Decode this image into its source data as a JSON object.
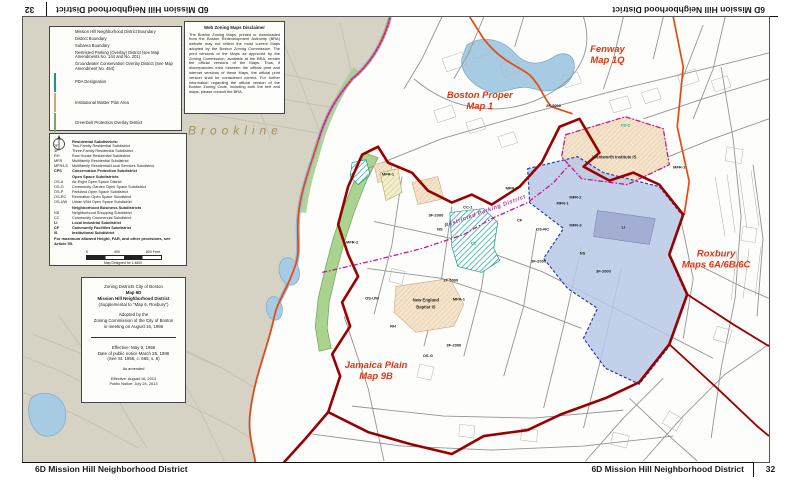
{
  "bars": {
    "title": "6D Mission Hill Neighborhood District",
    "page_number": "32"
  },
  "disclaimer": {
    "title": "Web Zoning Maps Disclaimer",
    "body": "The Boston Zoning Maps, printed or downloaded from the Boston Redevelopment Authority (BRA) website may not reflect the most current Maps adopted by the Boston Zoning Commission. The print versions of the Maps as approved by the Zoning Commission, available at the BRA, remain the official versions of the Maps. Thus, if discrepancies exist between the official print and internet versions of these Maps, the official print version shall be considered correct. For further information regarding the official version of the Boston Zoning Code, including both the text and maps, please consult the BRA."
  },
  "legend_overlays": {
    "items": [
      {
        "sw": "line-dark",
        "label": "Mission Hill Neighborhood District Boundary"
      },
      {
        "sw": "line-orange",
        "label": "District Boundary"
      },
      {
        "sw": "line-gray",
        "label": "Subarea Boundary"
      },
      {
        "sw": "dash-pink",
        "label": "Restricted Parking (Overlay) District (see Map Amendments No. 144 and No. 201)"
      },
      {
        "sw": "dots-pink",
        "label": "Groundwater Conservation Overlay District (See Map Amendment No. 454)"
      },
      {
        "sw": "teal",
        "label": "PDA Designation"
      },
      {
        "sw": "peach",
        "label": "Institutional Master Plan Area"
      },
      {
        "sw": "green",
        "label": "Greenbelt Protection Overlay District"
      },
      {
        "sw": "blue",
        "label": "Special Study Overlay District"
      },
      {
        "sw": "text",
        "code": "CC, CPS",
        "label": "PDA Permitted"
      }
    ]
  },
  "legend_subdistricts": {
    "sections": [
      {
        "header": "Residential Subdistricts:",
        "rows": [
          [
            "2F",
            "Two-Family Residential Subdistrict"
          ],
          [
            "3F",
            "Three-Family Residential Subdistrict"
          ],
          [
            "RH",
            "Row House Residential Subdistrict"
          ],
          [
            "MFR",
            "Multifamily Residential Subdistrict"
          ],
          [
            "MFR/LS",
            "Multifamily Residential/Local Services Subdistrict"
          ]
        ]
      },
      {
        "header": "",
        "bold": true,
        "rows": [
          [
            "CPS",
            "Conservation Protection Subdistrict"
          ]
        ]
      },
      {
        "header": "Open Space Subdistricts",
        "rows": [
          [
            "OS-A",
            "Air-Right Open Space District"
          ],
          [
            "OS-G",
            "Community Garden Open Space Subdistrict"
          ],
          [
            "OS-P",
            "Parkland Open Space Subdistrict"
          ],
          [
            "OS-RC",
            "Recreation Open Space Subdistrict"
          ],
          [
            "OS-UW",
            "Urban Wild Open Space Subdistrict"
          ]
        ]
      },
      {
        "header": "Neighborhood Business Subdistricts",
        "rows": [
          [
            "NS",
            "Neighborhood Shopping Subdistrict"
          ],
          [
            "CC",
            "Community Commercial Subdistrict"
          ]
        ]
      },
      {
        "header": "",
        "bold": true,
        "rows": [
          [
            "LI",
            "Local Industrial Subdistrict"
          ]
        ]
      },
      {
        "header": "",
        "bold": true,
        "rows": [
          [
            "CF",
            "Community Facilities Subdistrict"
          ]
        ]
      },
      {
        "header": "",
        "bold": true,
        "rows": [
          [
            "IS",
            "Institutional Subdistrict"
          ]
        ]
      }
    ],
    "note": "For maximum allowed Height, FAR, and other provisions, see Article 59."
  },
  "scale": {
    "ticks": [
      "0",
      "400",
      "800 Feet"
    ],
    "caption": "Map Designed for 1:4800"
  },
  "title_block": {
    "lines": [
      {
        "t": "Zoning Districts City of Boston"
      },
      {
        "t": "Map 6D",
        "b": 1
      },
      {
        "t": "Mission Hill Neighborhood District",
        "b": 1
      },
      {
        "t": "(Supplemental to \"Map 6, Roxbury\")"
      },
      {
        "sp": 1
      },
      {
        "t": "Adopted by the"
      },
      {
        "t": "Zoning Commission of the City of Boston"
      },
      {
        "t": "in meeting on August 15, 1996"
      },
      {
        "hr": 1
      },
      {
        "t": "Effective: May 9, 1996"
      },
      {
        "t": "Date of public notice March 25, 1996"
      },
      {
        "t": "(See St. 1956, c. 665, s. 5)"
      },
      {
        "sp": 1
      },
      {
        "t": "As amended",
        "small": 1
      },
      {
        "sp": 1
      },
      {
        "t": "Effective: August 16, 2013",
        "small": 1
      },
      {
        "t": "Public Notice: July 24, 2013",
        "small": 1
      }
    ]
  },
  "map": {
    "labels": [
      {
        "t": "Brookline",
        "x": 213,
        "y": 118,
        "c": "brookline",
        "n": "brookline-label"
      },
      {
        "t": "Boston Proper",
        "x": 458,
        "y": 81,
        "c": "district",
        "n": "boston-proper-label"
      },
      {
        "t": "Map 1",
        "x": 458,
        "y": 92,
        "c": "district",
        "n": "boston-proper-label"
      },
      {
        "t": "Fenway",
        "x": 586,
        "y": 35,
        "c": "district",
        "n": "fenway-label"
      },
      {
        "t": "Map 1Q",
        "x": 586,
        "y": 46,
        "c": "district",
        "n": "fenway-label"
      },
      {
        "t": "Roxbury",
        "x": 695,
        "y": 240,
        "c": "district",
        "n": "roxbury-label"
      },
      {
        "t": "Maps 6A/6B/6C",
        "x": 695,
        "y": 251,
        "c": "district",
        "n": "roxbury-label"
      },
      {
        "t": "Jamaica Plain",
        "x": 354,
        "y": 352,
        "c": "district",
        "n": "jamaica-plain-label"
      },
      {
        "t": "Map 9B",
        "x": 354,
        "y": 363,
        "c": "district",
        "n": "jamaica-plain-label"
      },
      {
        "t": "Restricted Parking District",
        "x": 464,
        "y": 196,
        "c": "parking",
        "r": -20,
        "n": "restricted-parking-label"
      },
      {
        "t": "Wentworth Institute IS",
        "x": 593,
        "y": 142,
        "c": "inst",
        "n": "institution-label"
      },
      {
        "t": "New England",
        "x": 404,
        "y": 285,
        "c": "inst",
        "n": "institution-label"
      },
      {
        "t": "Baptist IS",
        "x": 404,
        "y": 292,
        "c": "inst",
        "n": "institution-label"
      },
      {
        "t": "MFR-1",
        "x": 366,
        "y": 159,
        "c": "zone"
      },
      {
        "t": "MFR-2",
        "x": 330,
        "y": 227,
        "c": "zone"
      },
      {
        "t": "3F-2000",
        "x": 414,
        "y": 200,
        "c": "zone"
      },
      {
        "t": "NS",
        "x": 418,
        "y": 214,
        "c": "zone"
      },
      {
        "t": "CC-1",
        "x": 446,
        "y": 192,
        "c": "zone"
      },
      {
        "t": "CC",
        "x": 452,
        "y": 228,
        "c": "zone-teal"
      },
      {
        "t": "CC-2",
        "x": 604,
        "y": 110,
        "c": "zone-teal"
      },
      {
        "t": "MFR-1",
        "x": 490,
        "y": 173,
        "c": "zone"
      },
      {
        "t": "MFR-2",
        "x": 554,
        "y": 182,
        "c": "zone"
      },
      {
        "t": "MFR-3",
        "x": 554,
        "y": 210,
        "c": "zone"
      },
      {
        "t": "OS-RC",
        "x": 521,
        "y": 214,
        "c": "zone"
      },
      {
        "t": "CF",
        "x": 498,
        "y": 205,
        "c": "zone"
      },
      {
        "t": "MFR-1",
        "x": 541,
        "y": 188,
        "c": "zone"
      },
      {
        "t": "LI",
        "x": 602,
        "y": 212,
        "c": "zone"
      },
      {
        "t": "NS",
        "x": 561,
        "y": 238,
        "c": "zone"
      },
      {
        "t": "3F-2000",
        "x": 517,
        "y": 246,
        "c": "zone"
      },
      {
        "t": "3F-2000",
        "x": 582,
        "y": 256,
        "c": "zone"
      },
      {
        "t": "2F-5000",
        "x": 429,
        "y": 265,
        "c": "zone"
      },
      {
        "t": "2F-5000",
        "x": 532,
        "y": 90,
        "c": "zone"
      },
      {
        "t": "MFR-1",
        "x": 437,
        "y": 284,
        "c": "zone"
      },
      {
        "t": "MFR-1",
        "x": 658,
        "y": 152,
        "c": "zone"
      },
      {
        "t": "RH",
        "x": 371,
        "y": 311,
        "c": "zone"
      },
      {
        "t": "OS-UW",
        "x": 350,
        "y": 283,
        "c": "zone"
      },
      {
        "t": "OS-G",
        "x": 406,
        "y": 341,
        "c": "zone"
      },
      {
        "t": "3F-2000",
        "x": 432,
        "y": 330,
        "c": "zone"
      }
    ]
  },
  "colors": {
    "nhd_boundary": "#990000",
    "district_boundary": "#e8490f",
    "restricted_parking": "#c8158d",
    "pda_teal": "#2db3a0",
    "institutional_peach": "#f5e4cb",
    "greenbelt_green": "#a9d38e",
    "special_study_blue": "#b9c8e6",
    "water_blue": "#a6cbe3",
    "background_beige": "#d6d3c5"
  }
}
